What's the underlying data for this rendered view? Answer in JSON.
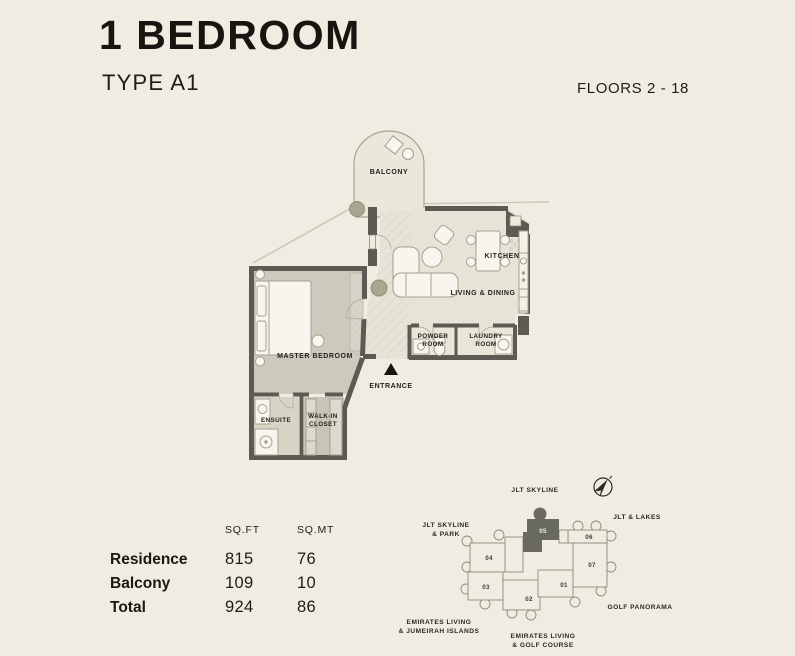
{
  "header": {
    "title": "1 BEDROOM",
    "subtitle": "TYPE A1",
    "floors_label": "FLOORS 2 - 18"
  },
  "colors": {
    "background": "#f0ece1",
    "wall": "#5b5b53",
    "floor_living": "#e7e3d6",
    "floor_bedroom": "#cccabc",
    "floor_service": "#e9e5d8",
    "floor_balcony": "#ebe7da",
    "furniture": "#f7f5ee",
    "keyplan_highlight": "#69695f",
    "text": "#1d1c18"
  },
  "plan": {
    "labels": {
      "balcony": "BALCONY",
      "kitchen": "KITCHEN",
      "living_dining": "LIVING & DINING",
      "powder": [
        "POWDER",
        "ROOM"
      ],
      "laundry": [
        "LAUNDRY",
        "ROOM"
      ],
      "master_bedroom": "MASTER BEDROOM",
      "ensuite": "ENSUITE",
      "walk_in_closet": [
        "WALK-IN",
        "CLOSET"
      ],
      "entrance": "ENTRANCE"
    }
  },
  "area_table": {
    "headers": [
      "SQ.FT",
      "SQ.MT"
    ],
    "rows": [
      {
        "label": "Residence",
        "sqft": "815",
        "sqmt": "76"
      },
      {
        "label": "Balcony",
        "sqft": "109",
        "sqmt": "10"
      },
      {
        "label": "Total",
        "sqft": "924",
        "sqmt": "86"
      }
    ]
  },
  "keyplan": {
    "units": [
      {
        "label": "01",
        "highlighted": false
      },
      {
        "label": "02",
        "highlighted": false
      },
      {
        "label": "03",
        "highlighted": false
      },
      {
        "label": "04",
        "highlighted": false
      },
      {
        "label": "05",
        "highlighted": true
      },
      {
        "label": "06",
        "highlighted": false
      },
      {
        "label": "07",
        "highlighted": false
      }
    ],
    "context_labels": {
      "top": "JLT SKYLINE",
      "right": "JLT & LAKES",
      "left": [
        "JLT SKYLINE",
        "& PARK"
      ],
      "bottom_right": "GOLF PANORAMA",
      "bottom_left": [
        "EMIRATES LIVING",
        "& JUMEIRAH ISLANDS"
      ],
      "bottom_center": [
        "EMIRATES LIVING",
        "& GOLF COURSE"
      ]
    }
  }
}
